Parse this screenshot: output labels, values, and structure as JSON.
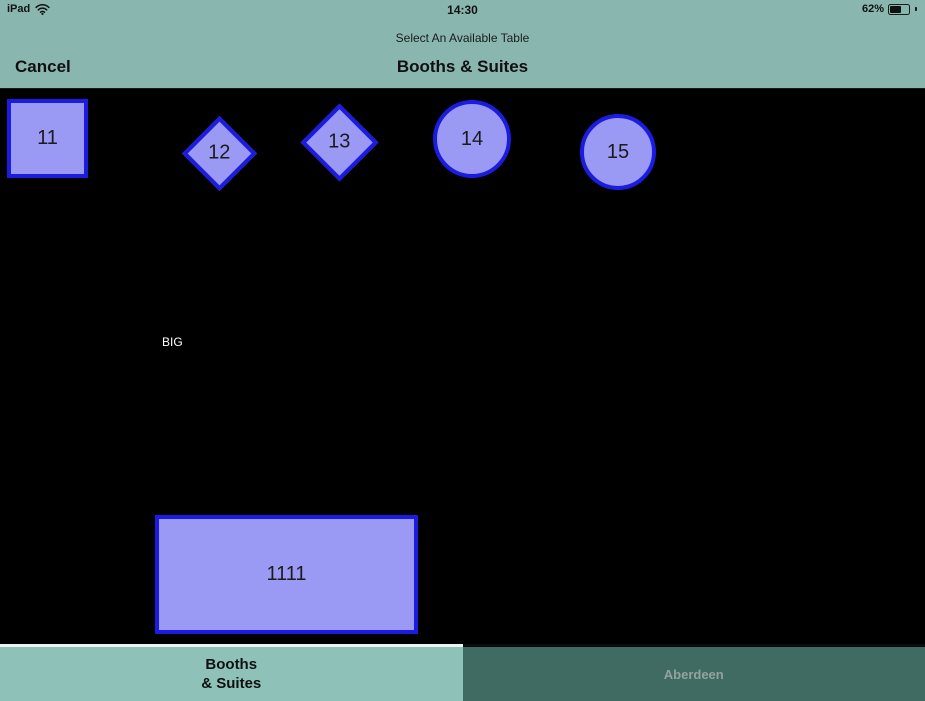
{
  "status_bar": {
    "device": "iPad",
    "time": "14:30",
    "battery_percent": "62%"
  },
  "header": {
    "subtitle": "Select An Available Table",
    "title": "Booths & Suites",
    "cancel_label": "Cancel"
  },
  "canvas": {
    "tables": [
      {
        "id": "11",
        "shape": "square",
        "x": 7,
        "y": 10,
        "w": 81,
        "h": 79
      },
      {
        "id": "12",
        "shape": "diamond",
        "cx": 219,
        "cy": 64,
        "size": 53
      },
      {
        "id": "13",
        "shape": "diamond",
        "cx": 339,
        "cy": 53,
        "size": 55
      },
      {
        "id": "14",
        "shape": "circle",
        "cx": 472,
        "cy": 50,
        "r": 39
      },
      {
        "id": "15",
        "shape": "circle",
        "cx": 618,
        "cy": 63,
        "r": 38
      },
      {
        "id": "1111",
        "shape": "rect",
        "x": 155,
        "y": 426,
        "w": 263,
        "h": 119
      }
    ],
    "labels": [
      {
        "text": "BIG",
        "x": 162,
        "y": 246
      }
    ]
  },
  "tabs": [
    {
      "label": "Booths\n& Suites",
      "active": true
    },
    {
      "label": "Aberdeen",
      "active": false
    }
  ],
  "colors": {
    "header_bg": "#8ab6b0",
    "canvas_bg": "#000000",
    "table_fill": "#9a99f4",
    "table_border": "#1c1ce0",
    "table_label": "#1b1b1b",
    "floor_label_text": "#ffffff",
    "tab_active_bg": "#8ec2b9",
    "tab_active_text": "#101010",
    "tab_inactive_bg": "#3f6b63",
    "tab_inactive_text": "#93a39e"
  }
}
